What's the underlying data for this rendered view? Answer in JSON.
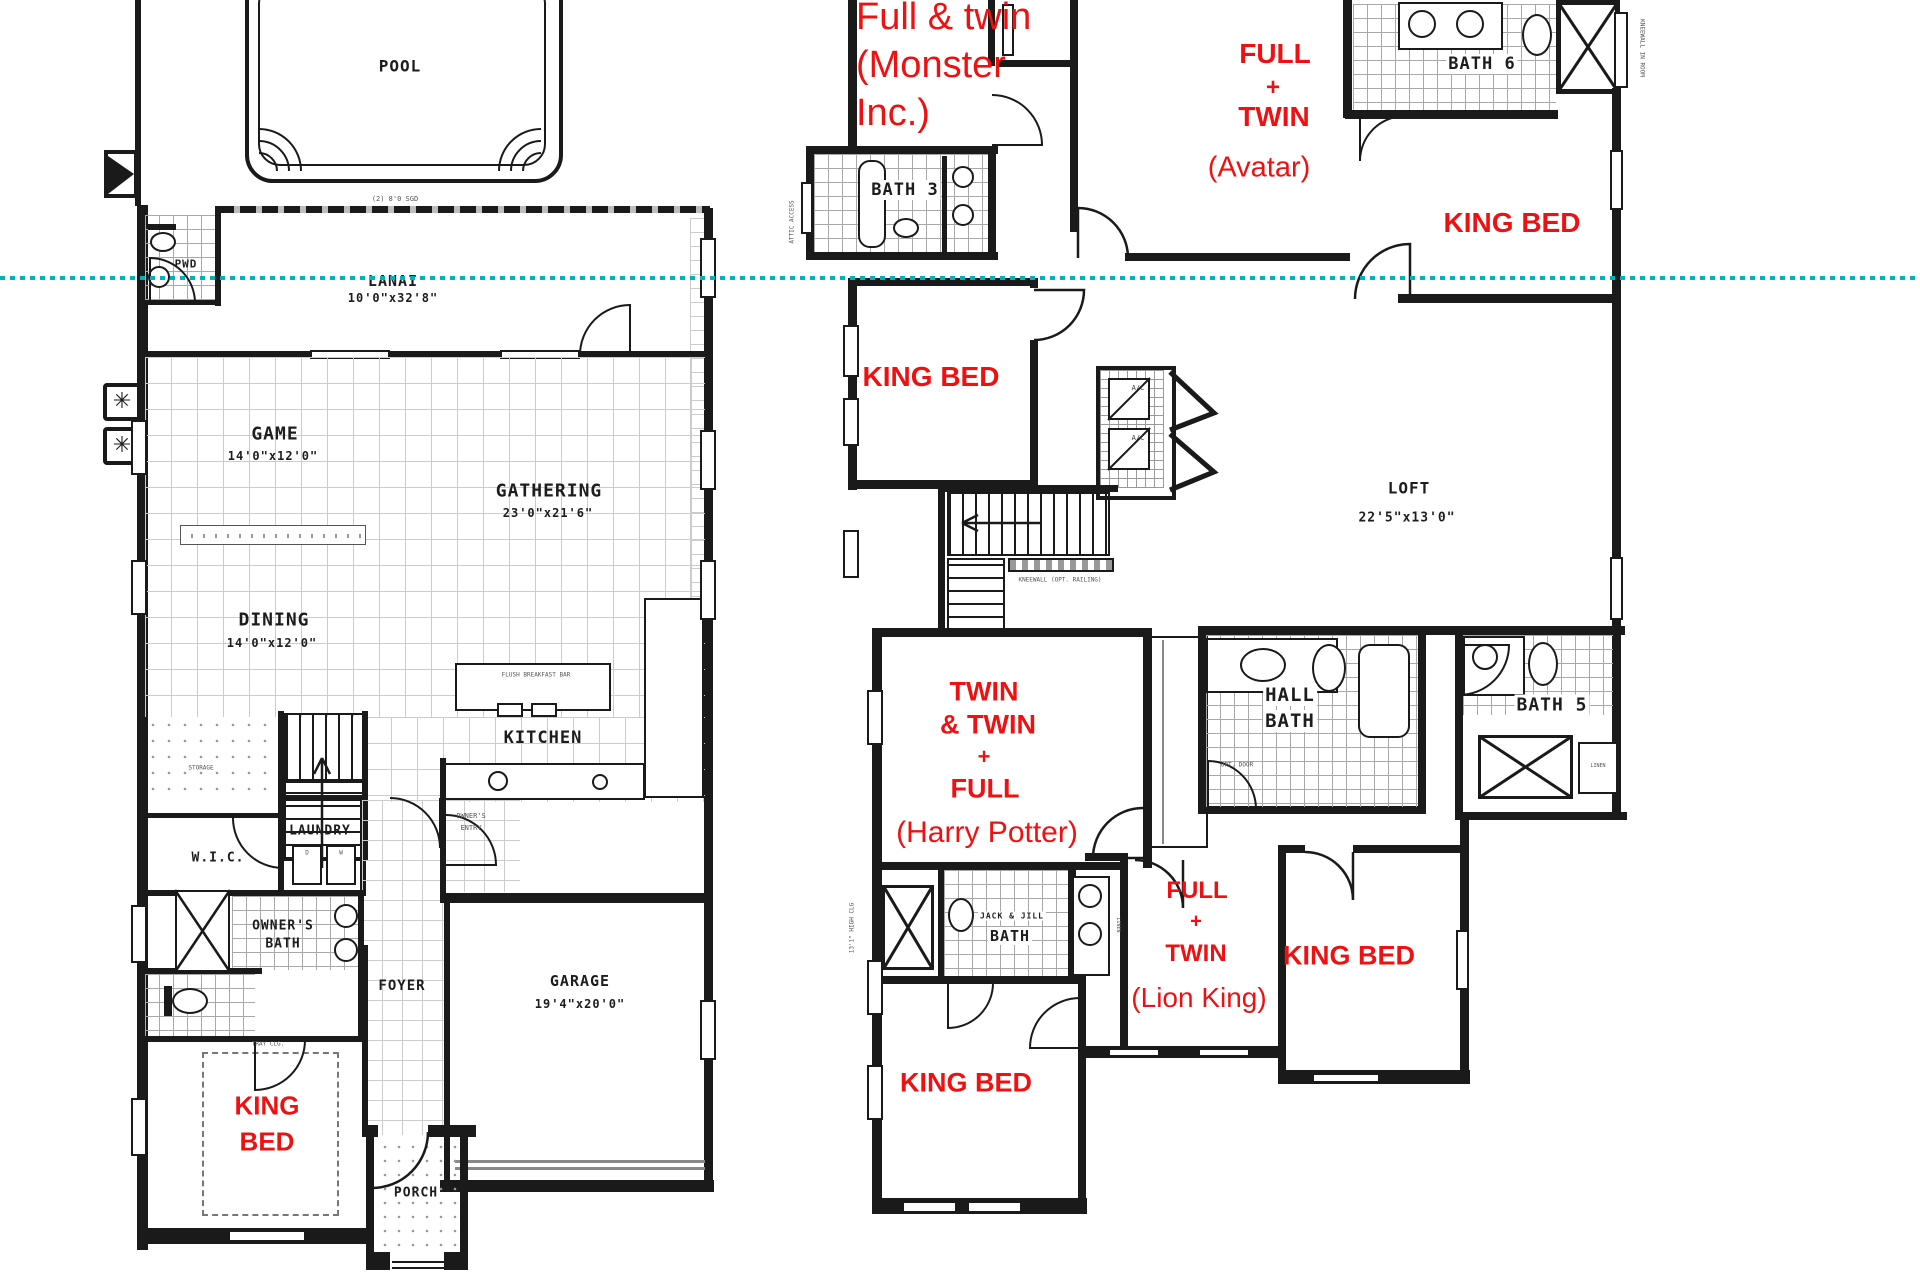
{
  "colors": {
    "annotation_red": "#ef1011",
    "section_line_teal": "#00b2c0",
    "plan_black": "#1a1a1a"
  },
  "f1": {
    "pool": "POOL",
    "lanai": "LANAI",
    "lanai_dim": "10'0\"x32'8\"",
    "sgd": "(2) 8'0 SGD",
    "pwd": "PWD",
    "game": "GAME",
    "game_dim": "14'0\"x12'0\"",
    "gathering": "GATHERING",
    "gathering_dim": "23'0\"x21'6\"",
    "dining": "DINING",
    "dining_dim": "14'0\"x12'0\"",
    "kitchen": "KITCHEN",
    "breakfast_bar": "FLUSH BREAKFAST BAR",
    "storage": "STORAGE",
    "laundry": "LAUNDRY",
    "washer": "W",
    "dryer": "D",
    "wic": "W.I.C.",
    "owners_entry_1": "OWNER'S",
    "owners_entry_2": "ENTRY",
    "owners_bath_1": "OWNER'S",
    "owners_bath_2": "BATH",
    "foyer": "FOYER",
    "garage": "GARAGE",
    "garage_dim": "19'4\"x20'0\"",
    "king_1": "KING",
    "king_2": "BED",
    "porch": "PORCH",
    "tray": "TRAY CLG."
  },
  "f2": {
    "room1_1": "Full & twin",
    "room1_2": "(Monster",
    "room1_3": "Inc.)",
    "bath3": "BATH 3",
    "room2_1": "FULL",
    "room2_2": "+",
    "room2_3": "TWIN",
    "room2_4": "(Avatar)",
    "bath6": "BATH 6",
    "king_top_right": "KING BED",
    "king_mid_left": "KING BED",
    "ac": "A/C",
    "loft": "LOFT",
    "loft_dim": "22'5\"x13'0\"",
    "kneewall": "KNEEWALL (OPT. RAILING)",
    "room3_1": "TWIN",
    "room3_2": "& TWIN",
    "room3_3": "+",
    "room3_4": "FULL",
    "room3_5": "(Harry Potter)",
    "hall_bath_1": "HALL",
    "hall_bath_2": "BATH",
    "opt": "OPT. DOOR",
    "bath5": "BATH 5",
    "linen": "LINEN",
    "jack_jill_1": "JACK & JILL",
    "jack_jill_2": "BATH",
    "room4_1": "FULL",
    "room4_2": "+",
    "room4_3": "TWIN",
    "room4_4": "(Lion King)",
    "king_bottom_right": "KING BED",
    "king_bottom_left": "KING BED",
    "attic": "ATTIC ACCESS",
    "high_clg": "13'1\" HIGH CLG",
    "kneewall_room": "KNEEWALL IN ROOM"
  }
}
